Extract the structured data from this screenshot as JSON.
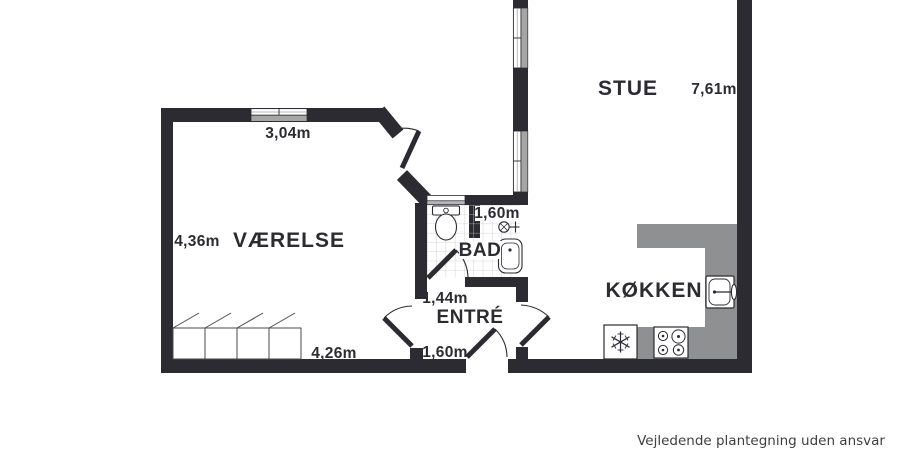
{
  "plan": {
    "labels": {
      "vaerelse": "VÆRELSE",
      "stue": "STUE",
      "bad": "BAD",
      "entre": "ENTRÉ",
      "koekken": "KØKKEN"
    },
    "dims": {
      "top_window": "3,04m",
      "vaerelse_left": "4,36m",
      "vaerelse_bottom": "4,26m",
      "stue_right": "7,61m",
      "bad_top": "1,60m",
      "entre_top": "1,44m",
      "entre_bottom": "1,60m"
    },
    "disclaimer": "Vejledende plantegning uden ansvar",
    "colors": {
      "background": "#ffffff",
      "wall": "#2b2b31",
      "counter_gray": "#8f9092",
      "window_gray": "#a5a5a5",
      "tile_line": "#c9c9c9",
      "label_text": "#2b2b31",
      "disclaimer_text": "#3f3f3f"
    },
    "icons": {
      "toilet": "toilet-icon",
      "bath_sink": "bathroom-sink-icon",
      "shower_mixer": "shower-mixer-icon",
      "freezer": "freezer-snowflake-icon",
      "stove": "stove-burners-icon",
      "kitchen_sink": "kitchen-sink-icon",
      "wardrobe": "wardrobe-icon"
    }
  }
}
